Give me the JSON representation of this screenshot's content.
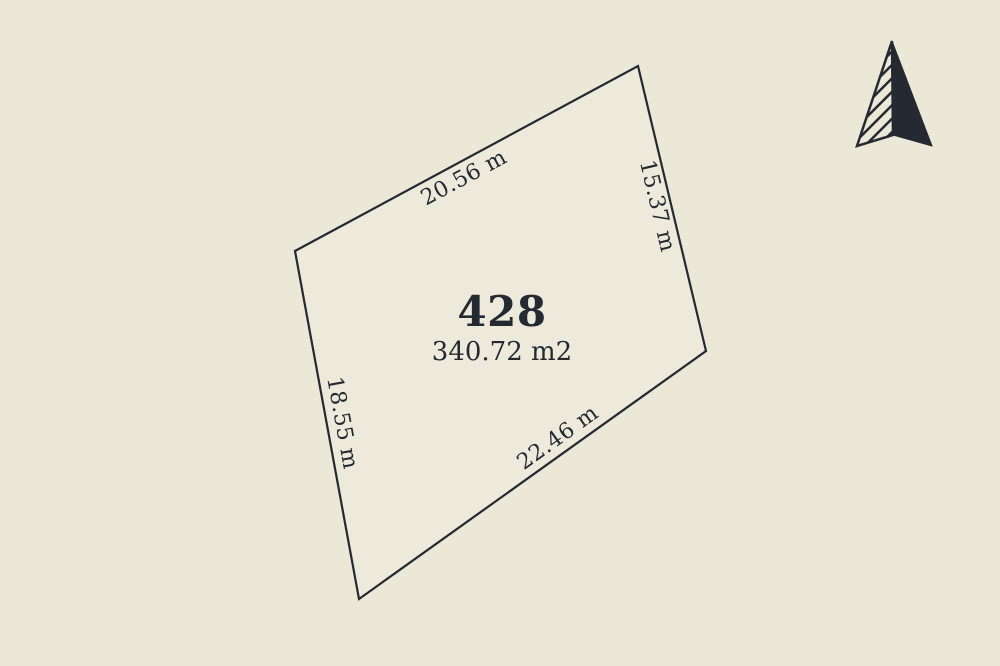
{
  "diagram": {
    "background_color": "#EBE8D8",
    "ink_color": "#252931",
    "lot": {
      "number": "428",
      "area_label": "340.72 m2",
      "fill_color": "#EDEADB",
      "boundary_px": [
        [
          295,
          251
        ],
        [
          638,
          66
        ],
        [
          706,
          351
        ],
        [
          359,
          599
        ]
      ],
      "edges": {
        "top": {
          "length_label": "20.56 m"
        },
        "right": {
          "length_label": "15.37 m"
        },
        "bottom": {
          "length_label": "22.46 m"
        },
        "left": {
          "length_label": "18.55 m"
        }
      }
    },
    "icons": {
      "north_arrow": "north-arrow-icon"
    }
  }
}
